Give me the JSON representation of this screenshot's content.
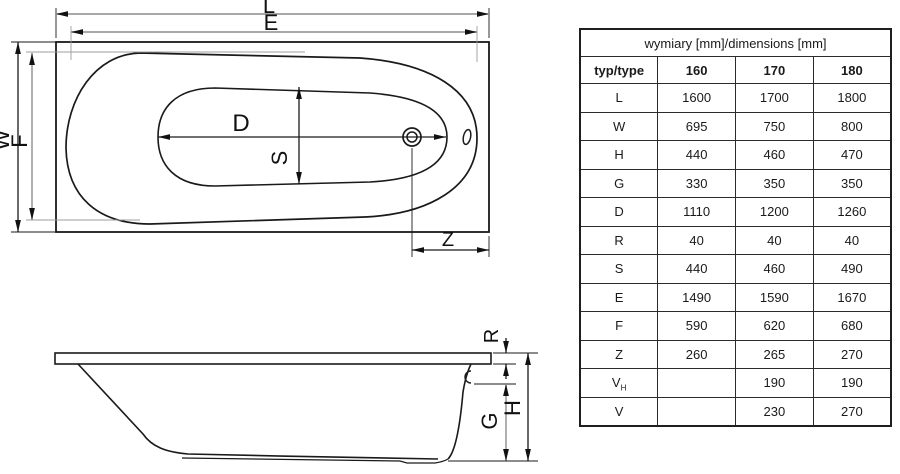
{
  "colors": {
    "line": "#1a1a1a",
    "dim_gray": "#9c9c9c",
    "background": "#ffffff"
  },
  "diagram": {
    "labels": {
      "L": "L",
      "E": "E",
      "W": "W",
      "F": "F",
      "D": "D",
      "S": "S",
      "Z": "Z",
      "R": "R",
      "G": "G",
      "H": "H"
    }
  },
  "table": {
    "title": "wymiary [mm]/dimensions [mm]",
    "type_header": "typ/type",
    "columns": [
      "160",
      "170",
      "180"
    ],
    "rows": [
      {
        "label": "L",
        "sub": "",
        "values": [
          "1600",
          "1700",
          "1800"
        ]
      },
      {
        "label": "W",
        "sub": "",
        "values": [
          "695",
          "750",
          "800"
        ]
      },
      {
        "label": "H",
        "sub": "",
        "values": [
          "440",
          "460",
          "470"
        ]
      },
      {
        "label": "G",
        "sub": "",
        "values": [
          "330",
          "350",
          "350"
        ]
      },
      {
        "label": "D",
        "sub": "",
        "values": [
          "1110",
          "1200",
          "1260"
        ]
      },
      {
        "label": "R",
        "sub": "",
        "values": [
          "40",
          "40",
          "40"
        ]
      },
      {
        "label": "S",
        "sub": "",
        "values": [
          "440",
          "460",
          "490"
        ]
      },
      {
        "label": "E",
        "sub": "",
        "values": [
          "1490",
          "1590",
          "1670"
        ]
      },
      {
        "label": "F",
        "sub": "",
        "values": [
          "590",
          "620",
          "680"
        ]
      },
      {
        "label": "Z",
        "sub": "",
        "values": [
          "260",
          "265",
          "270"
        ]
      },
      {
        "label": "V",
        "sub": "H",
        "values": [
          "",
          "190",
          "190"
        ]
      },
      {
        "label": "V",
        "sub": "",
        "values": [
          "",
          "230",
          "270"
        ]
      }
    ]
  }
}
